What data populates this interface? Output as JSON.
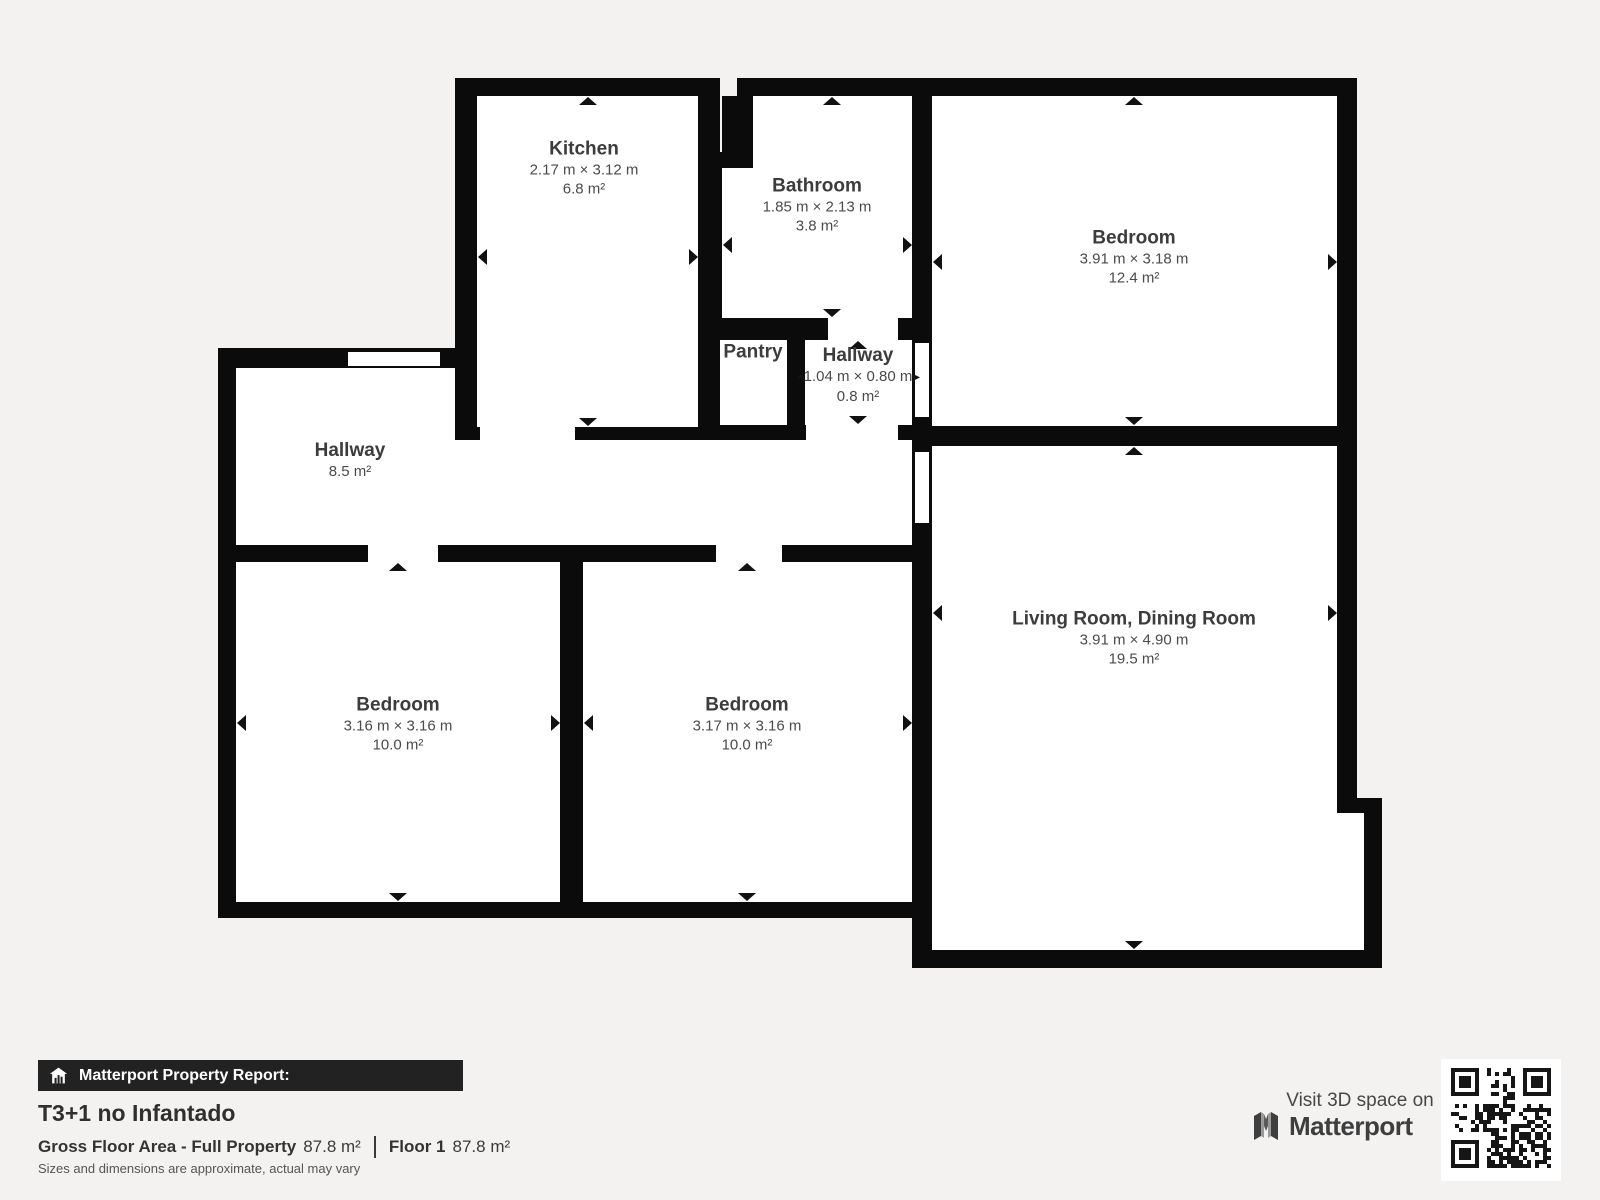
{
  "rooms": {
    "kitchen": {
      "name": "Kitchen",
      "dims": "2.17 m × 3.12 m",
      "area": "6.8 m²"
    },
    "bathroom": {
      "name": "Bathroom",
      "dims": "1.85 m × 2.13 m",
      "area": "3.8 m²"
    },
    "bedroom_top_right": {
      "name": "Bedroom",
      "dims": "3.91 m × 3.18 m",
      "area": "12.4 m²"
    },
    "pantry": {
      "name": "Pantry"
    },
    "hallway_small": {
      "name": "Hallway",
      "dims": "1.04 m × 0.80 m",
      "area": "0.8 m²"
    },
    "hallway": {
      "name": "Hallway",
      "area": "8.5 m²"
    },
    "bedroom_bottom_left": {
      "name": "Bedroom",
      "dims": "3.16 m × 3.16 m",
      "area": "10.0 m²"
    },
    "bedroom_bottom_middle": {
      "name": "Bedroom",
      "dims": "3.17 m × 3.16 m",
      "area": "10.0 m²"
    },
    "living_dining": {
      "name": "Living Room, Dining Room",
      "dims": "3.91 m × 4.90 m",
      "area": "19.5 m²"
    }
  },
  "footer": {
    "report_bar_label": "Matterport Property Report:",
    "property_title": "T3+1 no Infantado",
    "gross_label": "Gross Floor Area - Full Property",
    "gross_value": "87.8 m²",
    "floor_label": "Floor 1",
    "floor_value": "87.8 m²",
    "disclaimer": "Sizes and dimensions are approximate, actual may vary",
    "visit_text": "Visit 3D space on",
    "brand": "Matterport"
  },
  "icons": {
    "report_house_icon": "house-with-bars",
    "brand_mark_icon": "matterport-m",
    "qr_code": "qr-code"
  },
  "colors": {
    "background": "#f3f2f0",
    "wall": "#0b0b0b",
    "room": "#ffffff",
    "report_bar": "#222222",
    "label_text": "#3c3c3c"
  }
}
